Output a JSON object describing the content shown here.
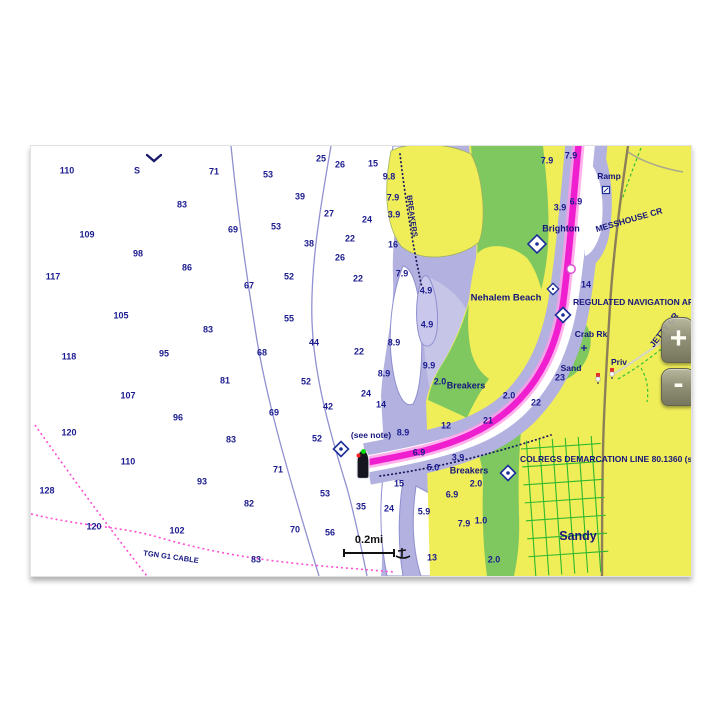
{
  "app": {
    "name": "chartplotter-chart-view"
  },
  "controls": {
    "zoom_in_label": "+",
    "zoom_out_label": "-"
  },
  "scale": {
    "label": "0.2mi"
  },
  "colors": {
    "route_magenta": "#ef1fd0",
    "route_glow": "#ff9ce8",
    "land_yellow": "#f0ee58",
    "vegetation_green": "#7fc85f",
    "shallow_periwinkle": "#b2b1df",
    "sounding_navy": "#1b1b8f",
    "cable_pink": "#ff4fd2",
    "road_brown": "#8c7f58",
    "grid_green": "#2eb82e"
  },
  "chart": {
    "type": "nautical-chart",
    "soundings": [
      {
        "t": "110",
        "x": 36,
        "y": 25
      },
      {
        "t": "S",
        "x": 106,
        "y": 25
      },
      {
        "t": "71",
        "x": 183,
        "y": 26
      },
      {
        "t": "53",
        "x": 237,
        "y": 29
      },
      {
        "t": "25",
        "x": 290,
        "y": 13
      },
      {
        "t": "26",
        "x": 309,
        "y": 19
      },
      {
        "t": "15",
        "x": 342,
        "y": 18
      },
      {
        "t": "9.8",
        "x": 358,
        "y": 31
      },
      {
        "t": "83",
        "x": 151,
        "y": 59
      },
      {
        "t": "39",
        "x": 269,
        "y": 51
      },
      {
        "t": "7.9",
        "x": 362,
        "y": 52
      },
      {
        "t": "3.9",
        "x": 363,
        "y": 69
      },
      {
        "t": "27",
        "x": 298,
        "y": 68
      },
      {
        "t": "24",
        "x": 336,
        "y": 74
      },
      {
        "t": "109",
        "x": 56,
        "y": 89
      },
      {
        "t": "69",
        "x": 202,
        "y": 84
      },
      {
        "t": "53",
        "x": 245,
        "y": 81
      },
      {
        "t": "22",
        "x": 319,
        "y": 93
      },
      {
        "t": "16",
        "x": 362,
        "y": 99
      },
      {
        "t": "38",
        "x": 278,
        "y": 98
      },
      {
        "t": "98",
        "x": 107,
        "y": 108
      },
      {
        "t": "26",
        "x": 309,
        "y": 112
      },
      {
        "t": "86",
        "x": 156,
        "y": 122
      },
      {
        "t": "117",
        "x": 22,
        "y": 131
      },
      {
        "t": "67",
        "x": 218,
        "y": 140
      },
      {
        "t": "52",
        "x": 258,
        "y": 131
      },
      {
        "t": "22",
        "x": 327,
        "y": 133
      },
      {
        "t": "7.9",
        "x": 371,
        "y": 128
      },
      {
        "t": "4.9",
        "x": 395,
        "y": 145
      },
      {
        "t": "105",
        "x": 90,
        "y": 170
      },
      {
        "t": "55",
        "x": 258,
        "y": 173
      },
      {
        "t": "83",
        "x": 177,
        "y": 184
      },
      {
        "t": "4.9",
        "x": 396,
        "y": 179
      },
      {
        "t": "8.9",
        "x": 363,
        "y": 197
      },
      {
        "t": "95",
        "x": 133,
        "y": 208
      },
      {
        "t": "68",
        "x": 231,
        "y": 207
      },
      {
        "t": "44",
        "x": 283,
        "y": 197
      },
      {
        "t": "22",
        "x": 328,
        "y": 206
      },
      {
        "t": "118",
        "x": 38,
        "y": 211
      },
      {
        "t": "9.9",
        "x": 398,
        "y": 220
      },
      {
        "t": "8.9",
        "x": 353,
        "y": 228
      },
      {
        "t": "81",
        "x": 194,
        "y": 235
      },
      {
        "t": "52",
        "x": 275,
        "y": 236
      },
      {
        "t": "2.0",
        "x": 409,
        "y": 236
      },
      {
        "t": "24",
        "x": 335,
        "y": 248
      },
      {
        "t": "107",
        "x": 97,
        "y": 250
      },
      {
        "t": "14",
        "x": 350,
        "y": 259
      },
      {
        "t": "96",
        "x": 147,
        "y": 272
      },
      {
        "t": "69",
        "x": 243,
        "y": 267
      },
      {
        "t": "42",
        "x": 297,
        "y": 261
      },
      {
        "t": "2.0",
        "x": 478,
        "y": 250
      },
      {
        "t": "22",
        "x": 505,
        "y": 257
      },
      {
        "t": "23",
        "x": 529,
        "y": 232
      },
      {
        "t": "12",
        "x": 415,
        "y": 280
      },
      {
        "t": "21",
        "x": 457,
        "y": 275
      },
      {
        "t": "8.9",
        "x": 372,
        "y": 287
      },
      {
        "t": "120",
        "x": 38,
        "y": 287
      },
      {
        "t": "83",
        "x": 200,
        "y": 294
      },
      {
        "t": "52",
        "x": 286,
        "y": 293
      },
      {
        "t": "6.9",
        "x": 388,
        "y": 307
      },
      {
        "t": "3.9",
        "x": 427,
        "y": 312
      },
      {
        "t": "5.0",
        "x": 402,
        "y": 322
      },
      {
        "t": "110",
        "x": 97,
        "y": 316
      },
      {
        "t": "71",
        "x": 247,
        "y": 324
      },
      {
        "t": "128",
        "x": 16,
        "y": 345
      },
      {
        "t": "93",
        "x": 171,
        "y": 336
      },
      {
        "t": "53",
        "x": 294,
        "y": 348
      },
      {
        "t": "15",
        "x": 368,
        "y": 338
      },
      {
        "t": "6.9",
        "x": 421,
        "y": 349
      },
      {
        "t": "2.0",
        "x": 445,
        "y": 338
      },
      {
        "t": "35",
        "x": 330,
        "y": 361
      },
      {
        "t": "24",
        "x": 358,
        "y": 363
      },
      {
        "t": "82",
        "x": 218,
        "y": 358
      },
      {
        "t": "5.9",
        "x": 393,
        "y": 366
      },
      {
        "t": "102",
        "x": 146,
        "y": 385
      },
      {
        "t": "70",
        "x": 264,
        "y": 384
      },
      {
        "t": "56",
        "x": 299,
        "y": 387
      },
      {
        "t": "1.0",
        "x": 450,
        "y": 375
      },
      {
        "t": "7.9",
        "x": 433,
        "y": 378
      },
      {
        "t": "120",
        "x": 63,
        "y": 381
      },
      {
        "t": "13",
        "x": 401,
        "y": 412
      },
      {
        "t": "2.0",
        "x": 463,
        "y": 414
      },
      {
        "t": "83",
        "x": 225,
        "y": 414
      },
      {
        "t": "7.9",
        "x": 516,
        "y": 15
      },
      {
        "t": "7.9",
        "x": 540,
        "y": 10
      },
      {
        "t": "6.9",
        "x": 545,
        "y": 56
      },
      {
        "t": "3.9",
        "x": 529,
        "y": 62
      },
      {
        "t": "14",
        "x": 555,
        "y": 139
      }
    ],
    "labels": [
      {
        "t": "Ramp",
        "x": 578,
        "y": 30,
        "size": 8.5
      },
      {
        "t": "Brighton",
        "x": 530,
        "y": 83,
        "size": 9
      },
      {
        "t": "MESSHOUSE CR",
        "x": 598,
        "y": 74,
        "size": 8.5,
        "rot": -16
      },
      {
        "t": "Nehalem Beach",
        "x": 475,
        "y": 152,
        "size": 9.5
      },
      {
        "t": "REGULATED NAVIGATION AREA",
        "x": 542,
        "y": 156,
        "size": 8.5,
        "anchor": "left"
      },
      {
        "t": "Crab Rk",
        "x": 560,
        "y": 188,
        "size": 8.5
      },
      {
        "t": "Sand",
        "x": 540,
        "y": 222,
        "size": 8.5
      },
      {
        "t": "Priv",
        "x": 588,
        "y": 216,
        "size": 8.5
      },
      {
        "t": "JETTY CR",
        "x": 633,
        "y": 184,
        "size": 8.5,
        "rot": -52
      },
      {
        "t": "Breakers",
        "x": 435,
        "y": 240,
        "size": 9
      },
      {
        "t": "Breakers",
        "x": 438,
        "y": 325,
        "size": 9
      },
      {
        "t": "COLREGS DEMARCATION LINE 80.1360 (see",
        "x": 489,
        "y": 313,
        "size": 8.5,
        "anchor": "left"
      },
      {
        "t": "Sandy",
        "x": 547,
        "y": 390,
        "size": 12.5
      },
      {
        "t": "(see note)",
        "x": 340,
        "y": 289,
        "size": 8.5
      },
      {
        "t": "BREAKERS",
        "x": 381,
        "y": 70,
        "size": 7.5,
        "rot": 82
      },
      {
        "t": "TGN G1 CABLE",
        "x": 140,
        "y": 411,
        "size": 7.5,
        "rot": 8
      }
    ],
    "markers": [
      {
        "type": "chevron",
        "x": 123,
        "y": 12
      },
      {
        "type": "diamond",
        "x": 506,
        "y": 98,
        "s": 18
      },
      {
        "type": "sq45",
        "x": 522,
        "y": 143,
        "s": 10
      },
      {
        "type": "diamond",
        "x": 532,
        "y": 169,
        "s": 15
      },
      {
        "type": "rockcross",
        "x": 553,
        "y": 202
      },
      {
        "type": "light",
        "x": 567,
        "y": 232
      },
      {
        "type": "light",
        "x": 581,
        "y": 227
      },
      {
        "type": "diamond",
        "x": 310,
        "y": 303,
        "s": 15
      },
      {
        "type": "diamond",
        "x": 477,
        "y": 327,
        "s": 15
      },
      {
        "type": "waypoint",
        "x": 540,
        "y": 123
      },
      {
        "type": "ramp",
        "x": 575,
        "y": 44
      },
      {
        "type": "wreck",
        "x": 372,
        "y": 407
      },
      {
        "type": "boat",
        "x": 332,
        "y": 318
      }
    ]
  }
}
